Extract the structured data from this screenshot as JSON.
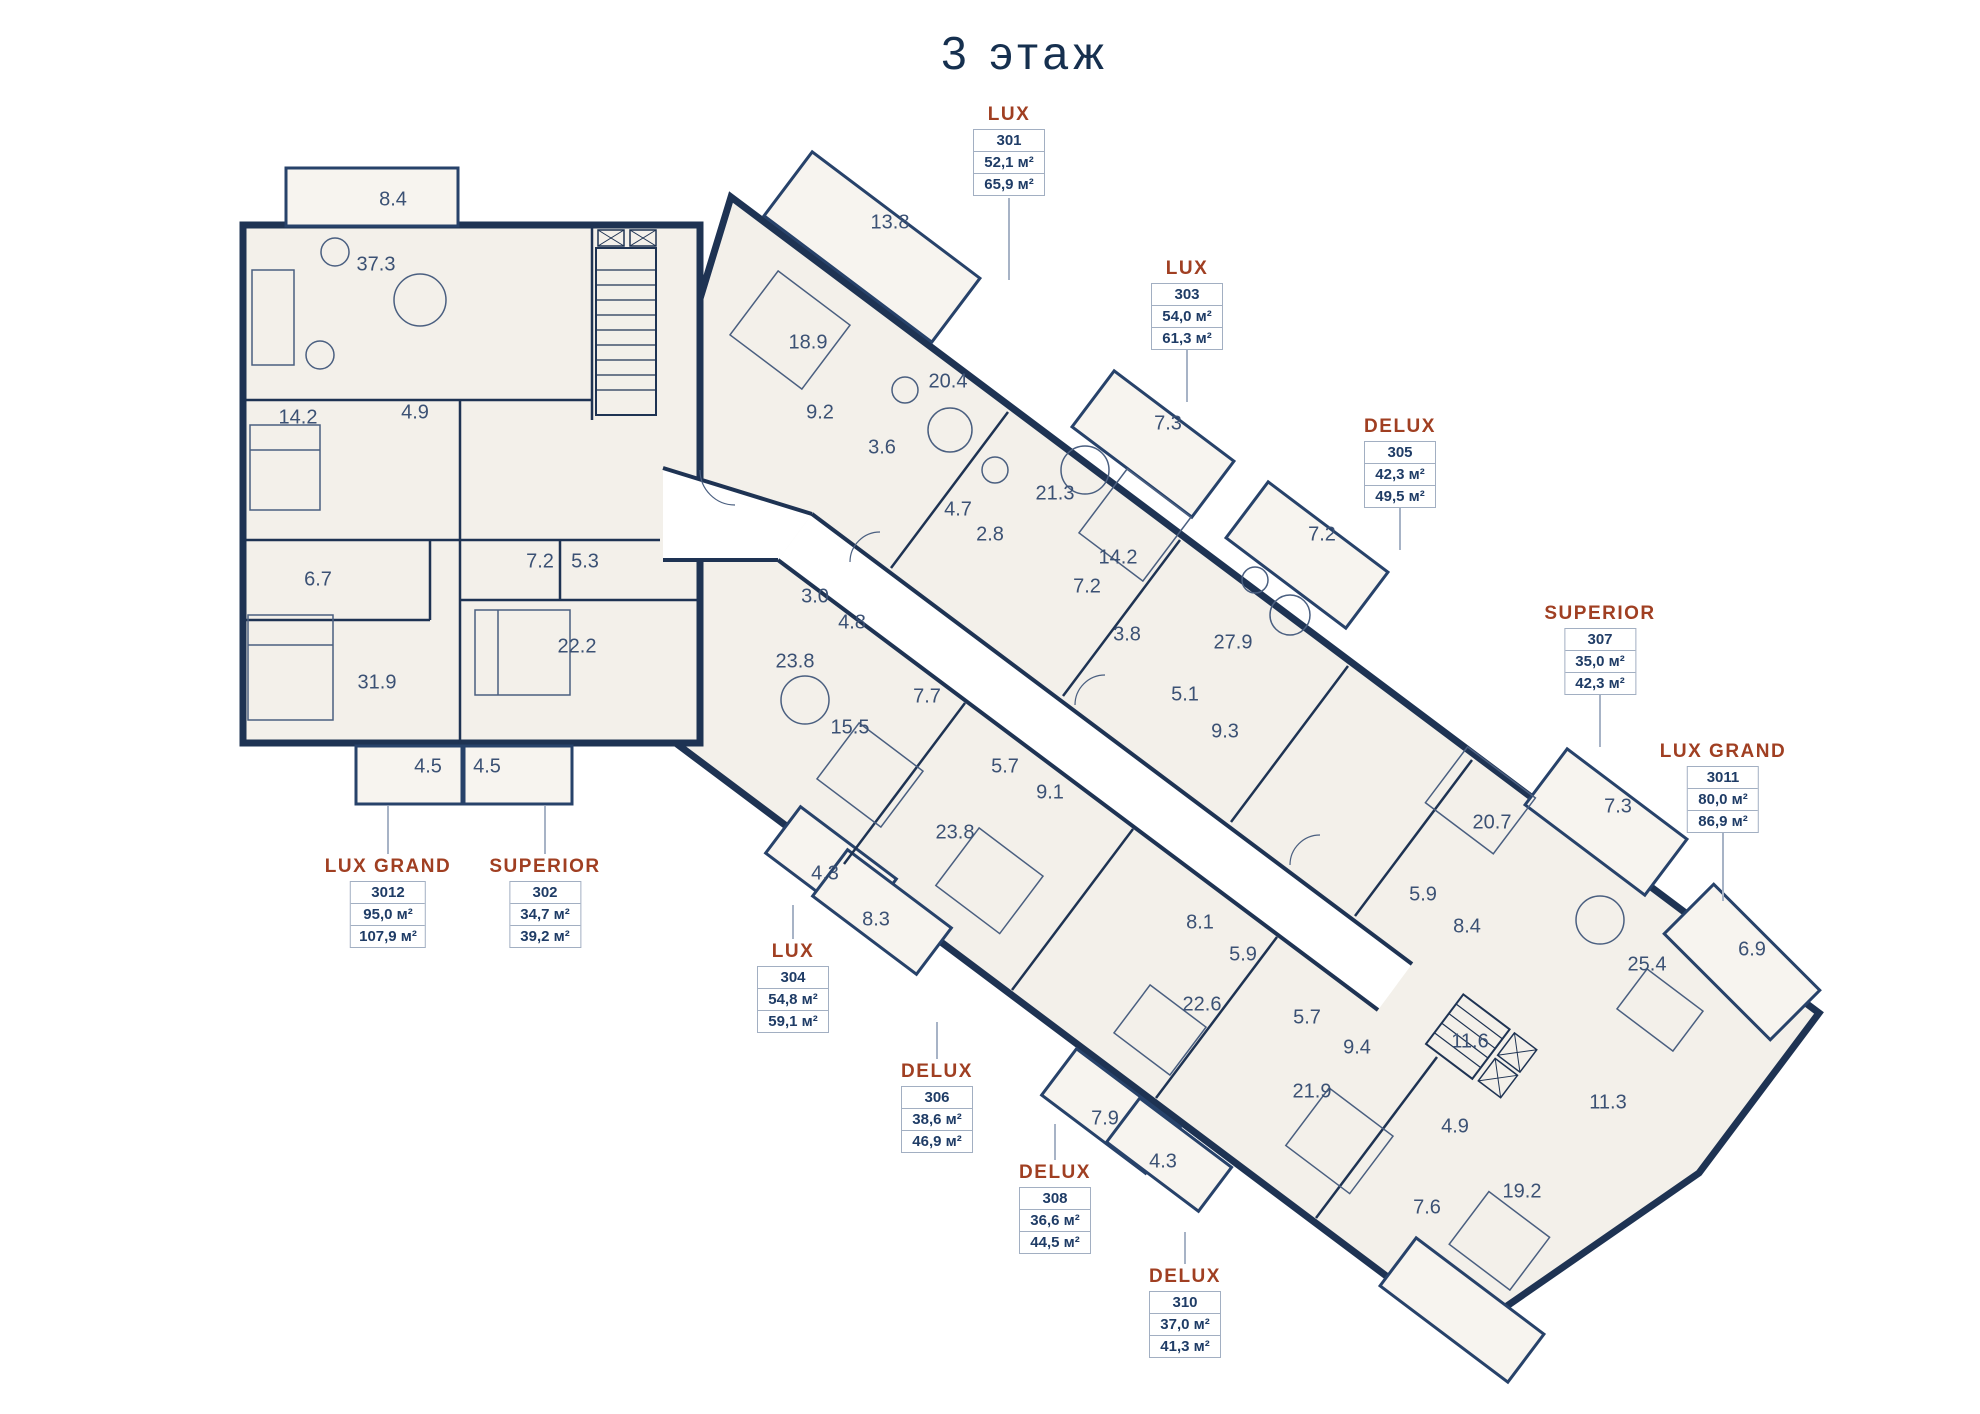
{
  "header": {
    "title": "3 этаж"
  },
  "colors": {
    "wall_navy": "#1e3353",
    "accent_rust": "#a03f22",
    "room_fill": "#f3f0ea",
    "balcony_fill": "#f7f4ef",
    "label_border": "#a2afc2",
    "room_text": "#3b5174",
    "unit_text": "#1f3c66"
  },
  "apartments": [
    {
      "type": "LUX",
      "unit": "301",
      "area1": "52,1 м²",
      "area2": "65,9 м²"
    },
    {
      "type": "LUX",
      "unit": "303",
      "area1": "54,0 м²",
      "area2": "61,3 м²"
    },
    {
      "type": "DELUX",
      "unit": "305",
      "area1": "42,3 м²",
      "area2": "49,5 м²"
    },
    {
      "type": "SUPERIOR",
      "unit": "307",
      "area1": "35,0 м²",
      "area2": "42,3 м²"
    },
    {
      "type": "LUX GRAND",
      "unit": "3011",
      "area1": "80,0 м²",
      "area2": "86,9 м²"
    },
    {
      "type": "LUX GRAND",
      "unit": "3012",
      "area1": "95,0 м²",
      "area2": "107,9 м²"
    },
    {
      "type": "SUPERIOR",
      "unit": "302",
      "area1": "34,7 м²",
      "area2": "39,2 м²"
    },
    {
      "type": "LUX",
      "unit": "304",
      "area1": "54,8 м²",
      "area2": "59,1 м²"
    },
    {
      "type": "DELUX",
      "unit": "306",
      "area1": "38,6 м²",
      "area2": "46,9 м²"
    },
    {
      "type": "DELUX",
      "unit": "308",
      "area1": "36,6 м²",
      "area2": "44,5 м²"
    },
    {
      "type": "DELUX",
      "unit": "310",
      "area1": "37,0 м²",
      "area2": "41,3 м²"
    }
  ],
  "rooms": [
    {
      "v": "8.4"
    },
    {
      "v": "37.3"
    },
    {
      "v": "14.2"
    },
    {
      "v": "4.9"
    },
    {
      "v": "6.7"
    },
    {
      "v": "31.9"
    },
    {
      "v": "7.2"
    },
    {
      "v": "5.3"
    },
    {
      "v": "22.2"
    },
    {
      "v": "4.5"
    },
    {
      "v": "4.5"
    },
    {
      "v": "13.8"
    },
    {
      "v": "18.9"
    },
    {
      "v": "20.4"
    },
    {
      "v": "9.2"
    },
    {
      "v": "3.6"
    },
    {
      "v": "21.3"
    },
    {
      "v": "4.7"
    },
    {
      "v": "2.8"
    },
    {
      "v": "14.2"
    },
    {
      "v": "7.2"
    },
    {
      "v": "7.3"
    },
    {
      "v": "3.8"
    },
    {
      "v": "7.2"
    },
    {
      "v": "27.9"
    },
    {
      "v": "5.1"
    },
    {
      "v": "9.3"
    },
    {
      "v": "7.3"
    },
    {
      "v": "20.7"
    },
    {
      "v": "5.9"
    },
    {
      "v": "8.4"
    },
    {
      "v": "25.4"
    },
    {
      "v": "6.9"
    },
    {
      "v": "11.6"
    },
    {
      "v": "3.0"
    },
    {
      "v": "4.8"
    },
    {
      "v": "23.8"
    },
    {
      "v": "7.7"
    },
    {
      "v": "15.5"
    },
    {
      "v": "4.3"
    },
    {
      "v": "8.3"
    },
    {
      "v": "5.7"
    },
    {
      "v": "9.1"
    },
    {
      "v": "23.8"
    },
    {
      "v": "7.9"
    },
    {
      "v": "4.3"
    },
    {
      "v": "8.1"
    },
    {
      "v": "5.9"
    },
    {
      "v": "22.6"
    },
    {
      "v": "5.7"
    },
    {
      "v": "9.4"
    },
    {
      "v": "21.9"
    },
    {
      "v": "4.9"
    },
    {
      "v": "7.6"
    },
    {
      "v": "19.2"
    },
    {
      "v": "11.3"
    }
  ]
}
